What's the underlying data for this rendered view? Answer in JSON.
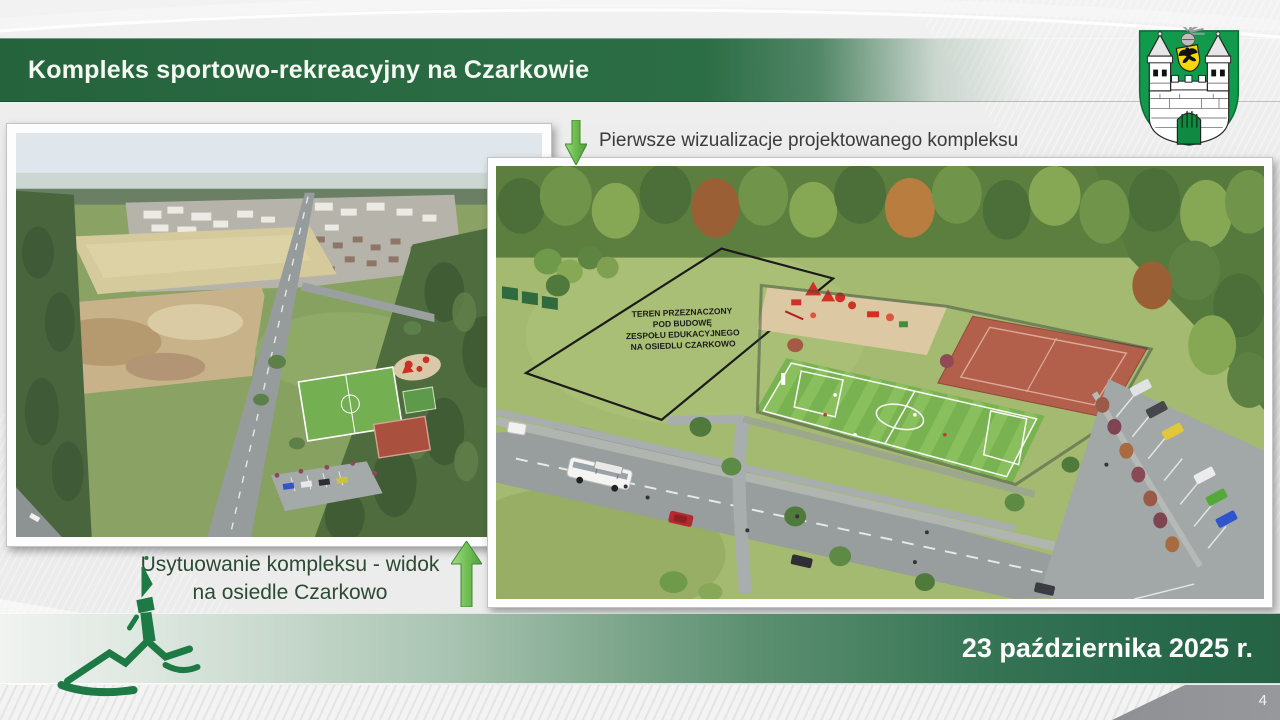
{
  "header": {
    "title": "Kompleks sportowo-rekreacyjny na Czarkowie"
  },
  "captions": {
    "top": "Pierwsze wizualizacje projektowanego kompleksu",
    "bottom_line1": "Usytuowanie kompleksu - widok",
    "bottom_line2": "na osiedle Czarkowo"
  },
  "visualization": {
    "plot_label_lines": [
      "TEREN PRZEZNACZONY",
      "POD BUDOWĘ",
      "ZESPOŁU EDUKACYJNEGO",
      "NA OSIEDLU CZARKOWO"
    ]
  },
  "footer": {
    "date": "23 października 2025 r.",
    "page_number": "4"
  },
  "icons": {
    "arrow_down": "green-arrow-down",
    "arrow_up": "green-arrow-up",
    "crest": "zielona-gora-coat-of-arms",
    "logo": "green-hill-tower-sketch"
  },
  "colors": {
    "header_green": "#2a6b43",
    "footer_green_dark": "#27674a",
    "arrow_green": "#5aa83e",
    "caption_green": "#2d4a33",
    "crest_green": "#119a4b",
    "page_wedge_gray": "#8f9094"
  }
}
